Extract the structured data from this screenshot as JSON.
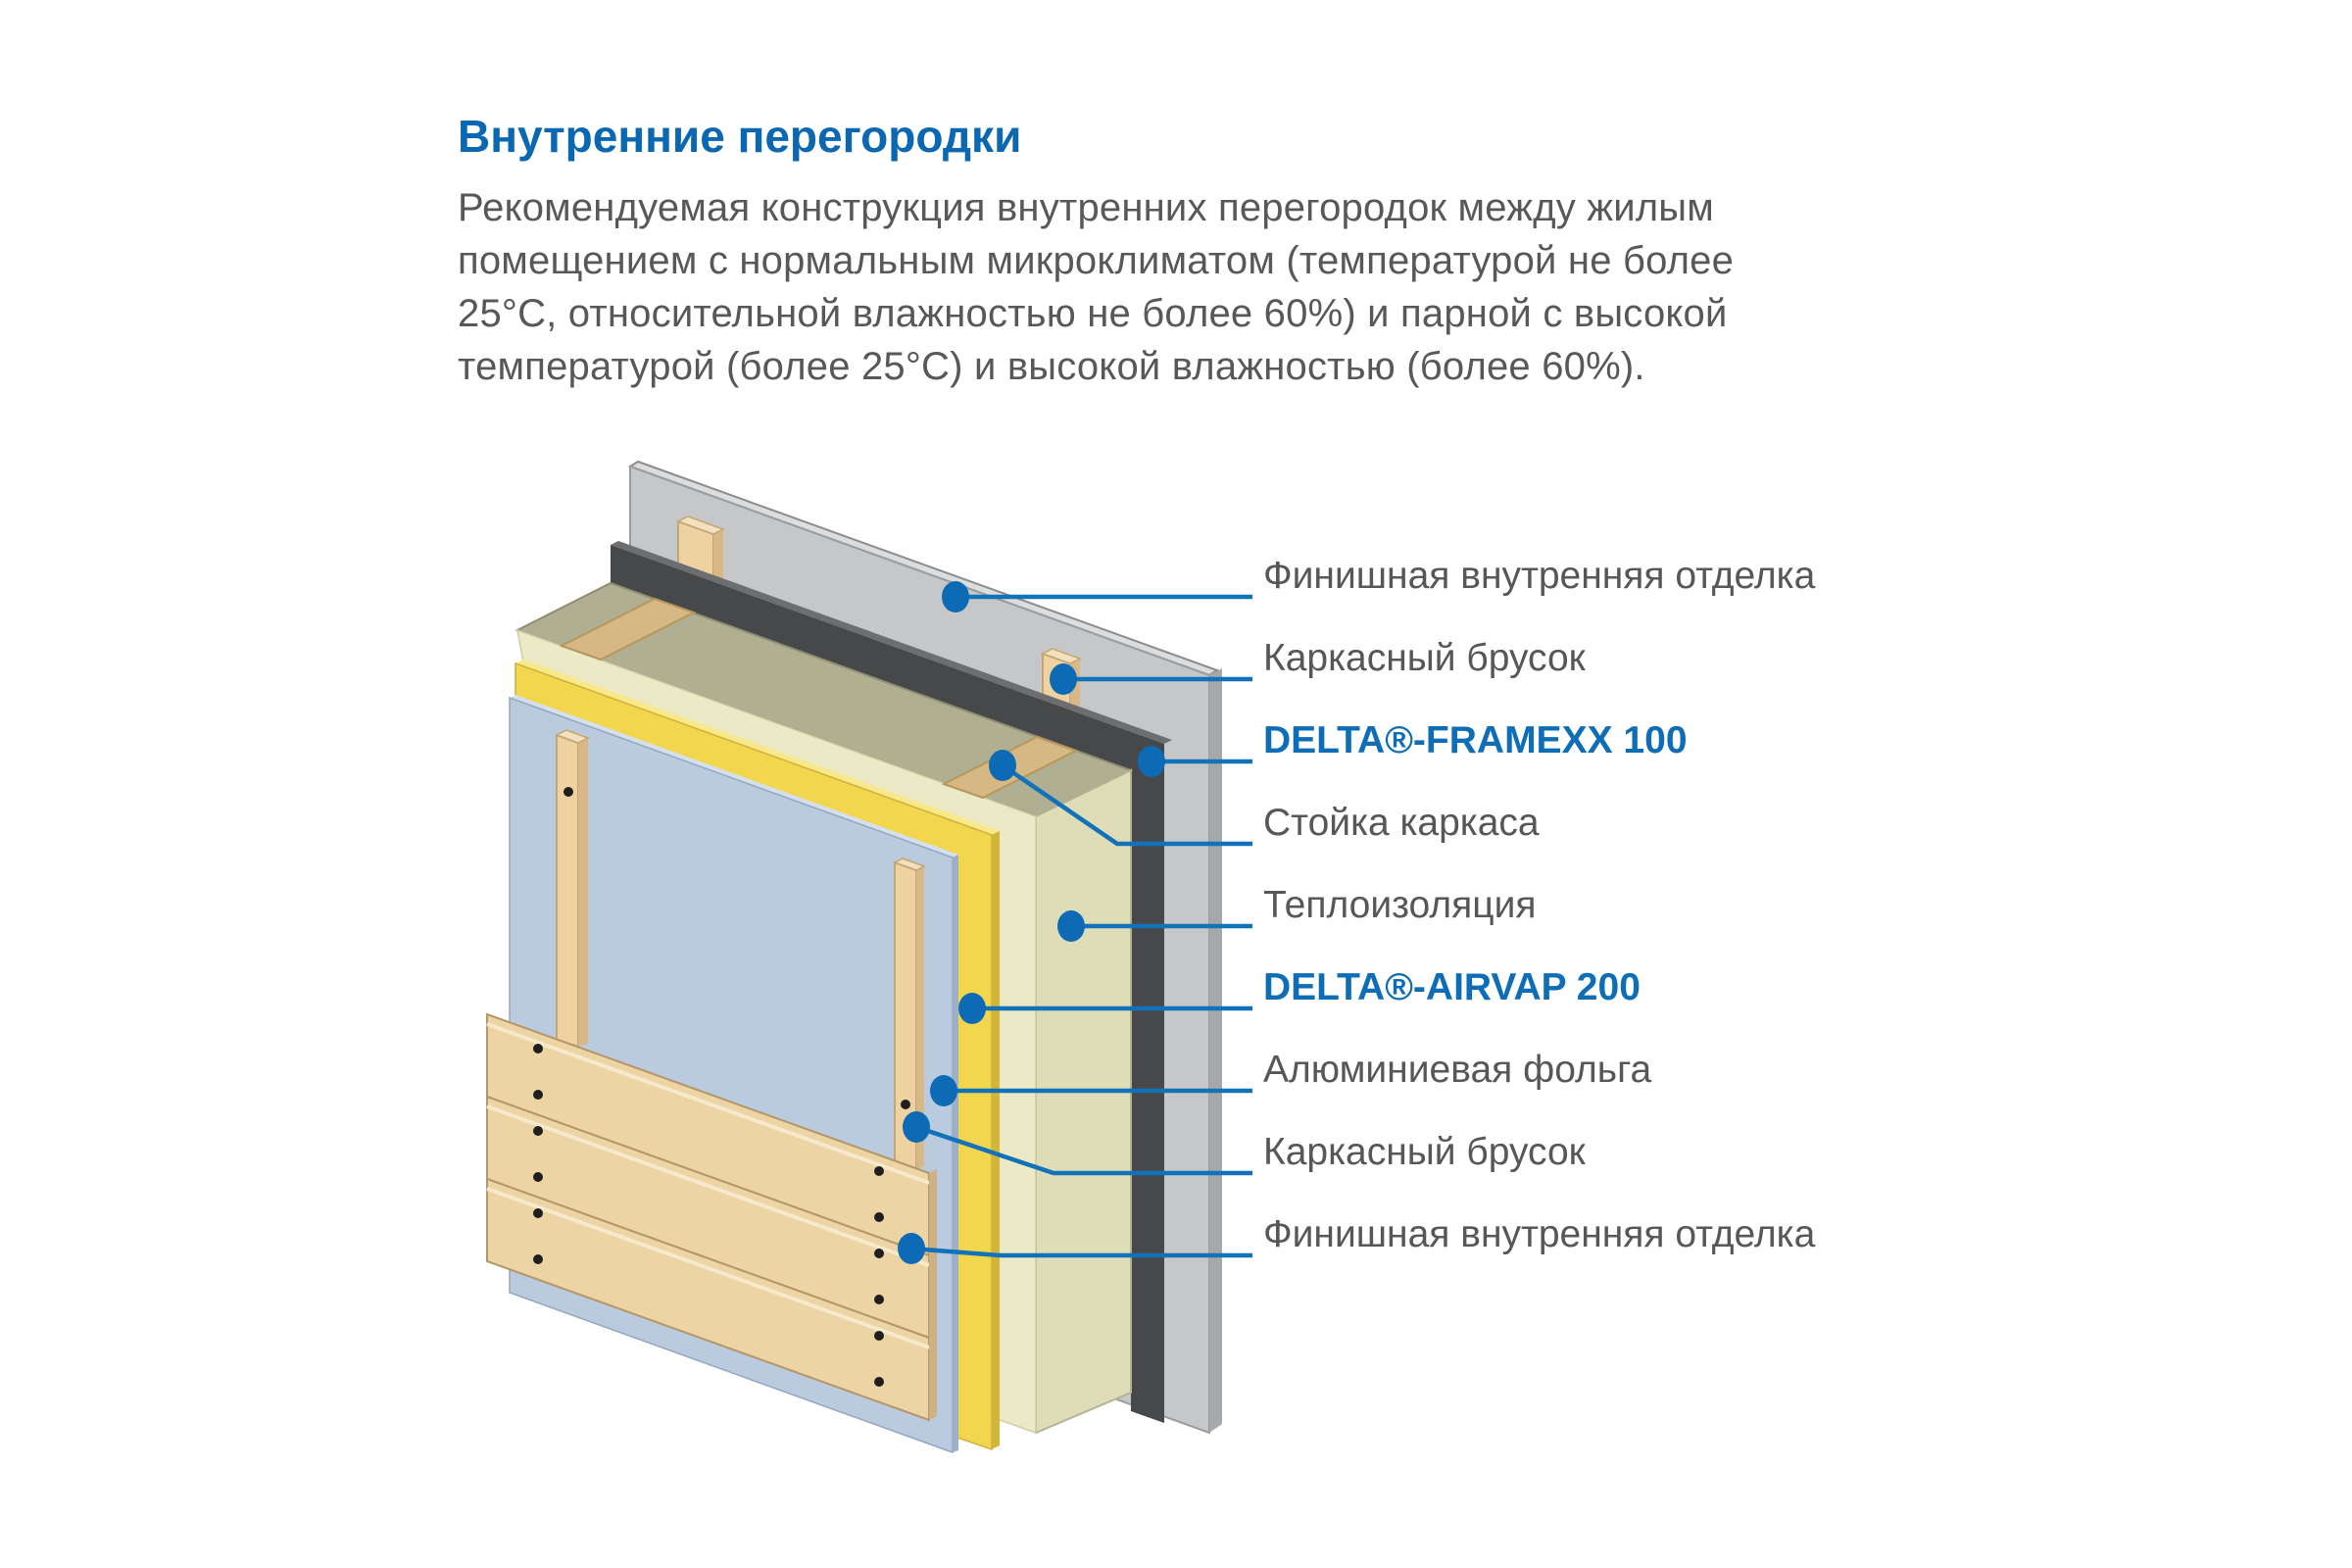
{
  "header": {
    "title": "Внутренние перегородки",
    "title_color": "#0a67b2"
  },
  "description": {
    "color": "#57585a",
    "lines": [
      "Рекомендуемая конструкция внутренних перегородок между жилым",
      "помещением с нормальным микроклиматом (температурой не более",
      "25°С, относительной влажностью не более 60%) и парной с высокой",
      "температурой (более 25°С) и высокой влажностью (более 60%)."
    ]
  },
  "diagram": {
    "accent_color": "#1272b9",
    "marker_color": "#0d6bb5",
    "callouts": [
      {
        "label": "Финишная внутренняя отделка",
        "style": "normal",
        "target": "back-finish-panel"
      },
      {
        "label": "Каркасный брусок",
        "style": "normal",
        "target": "back-frame-batten"
      },
      {
        "label": "DELTA®-FRAMEXX 100",
        "style": "brand",
        "target": "framexx-membrane"
      },
      {
        "label": "Стойка каркаса",
        "style": "normal",
        "target": "frame-stud"
      },
      {
        "label": "Теплоизоляция",
        "style": "normal",
        "target": "thermal-insulation"
      },
      {
        "label": "DELTA®-AIRVAP 200",
        "style": "brand",
        "target": "airvap-membrane"
      },
      {
        "label": "Алюминиевая фольга",
        "style": "normal",
        "target": "aluminium-foil"
      },
      {
        "label": "Каркасный брусок",
        "style": "normal",
        "target": "front-frame-batten"
      },
      {
        "label": "Финишная внутренняя отделка",
        "style": "normal",
        "target": "front-finish-planks"
      }
    ],
    "layer_colors": {
      "gray_panel": "#c6c7c9",
      "gray_panel_top": "#dcddde",
      "gray_panel_side": "#a6a8aa",
      "membrane_dark": "#47484a",
      "membrane_dark_top": "#6d6e70",
      "insulation_top": "#b1af91",
      "insulation_side": "#deddb8",
      "insulation_front": "#ebe9c6",
      "vapour_yellow": "#f2d64e",
      "vapour_yellow_top": "#f8e88a",
      "vapour_yellow_side": "#d2b63a",
      "foil_blue": "#bacbdf",
      "foil_blue_top": "#d6e0ed",
      "foil_blue_side": "#9cb0c8",
      "wood_face": "#eed2a2",
      "wood_side": "#d8b886",
      "wood_top": "#f3e0bf",
      "plank_face": "#ecd4a4",
      "plank_side": "#cdb083"
    }
  }
}
